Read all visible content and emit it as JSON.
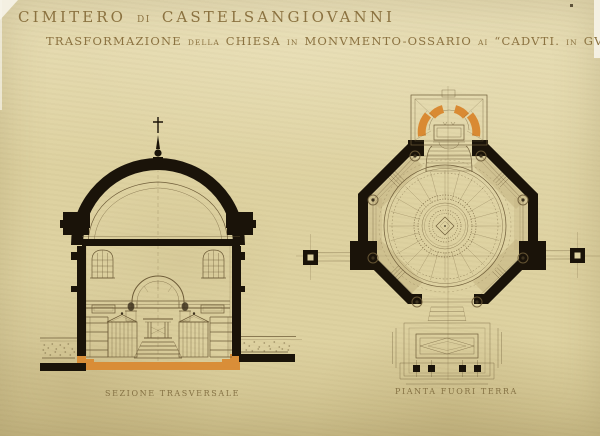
{
  "colors": {
    "paper": "#ded2a1",
    "paper_hi": "#e8deb6",
    "paper_lo": "#cdbf8b",
    "ink": "#6e5c38",
    "ink_dark": "#3e331f",
    "black": "#1a1309",
    "orange": "#d98a33",
    "tan": "#c2b282",
    "title_ink": "#8b7240",
    "caption_ink": "#7d693c",
    "edge_white": "#f7f4e9"
  },
  "header": {
    "title": {
      "parts": [
        {
          "t": "CIMITERO"
        },
        {
          "t": "DI"
        },
        {
          "t": "CASTELSANGIOVANNI"
        }
      ]
    },
    "subtitle": {
      "parts": [
        {
          "t": "TRASFORMAZIONE"
        },
        {
          "t": "DELLA"
        },
        {
          "t": "CHIESA"
        },
        {
          "t": "IN"
        },
        {
          "t": "MONVMENTO-OSSARIO"
        },
        {
          "t": "AI"
        },
        {
          "t": "“CADVTI."
        },
        {
          "t": "IN"
        },
        {
          "t": "GVERRA"
        }
      ]
    }
  },
  "drawings": {
    "section": {
      "caption": "SEZIONE TRASVERSALE"
    },
    "plan": {
      "caption": "PIANTA FUORI TERRA"
    }
  }
}
